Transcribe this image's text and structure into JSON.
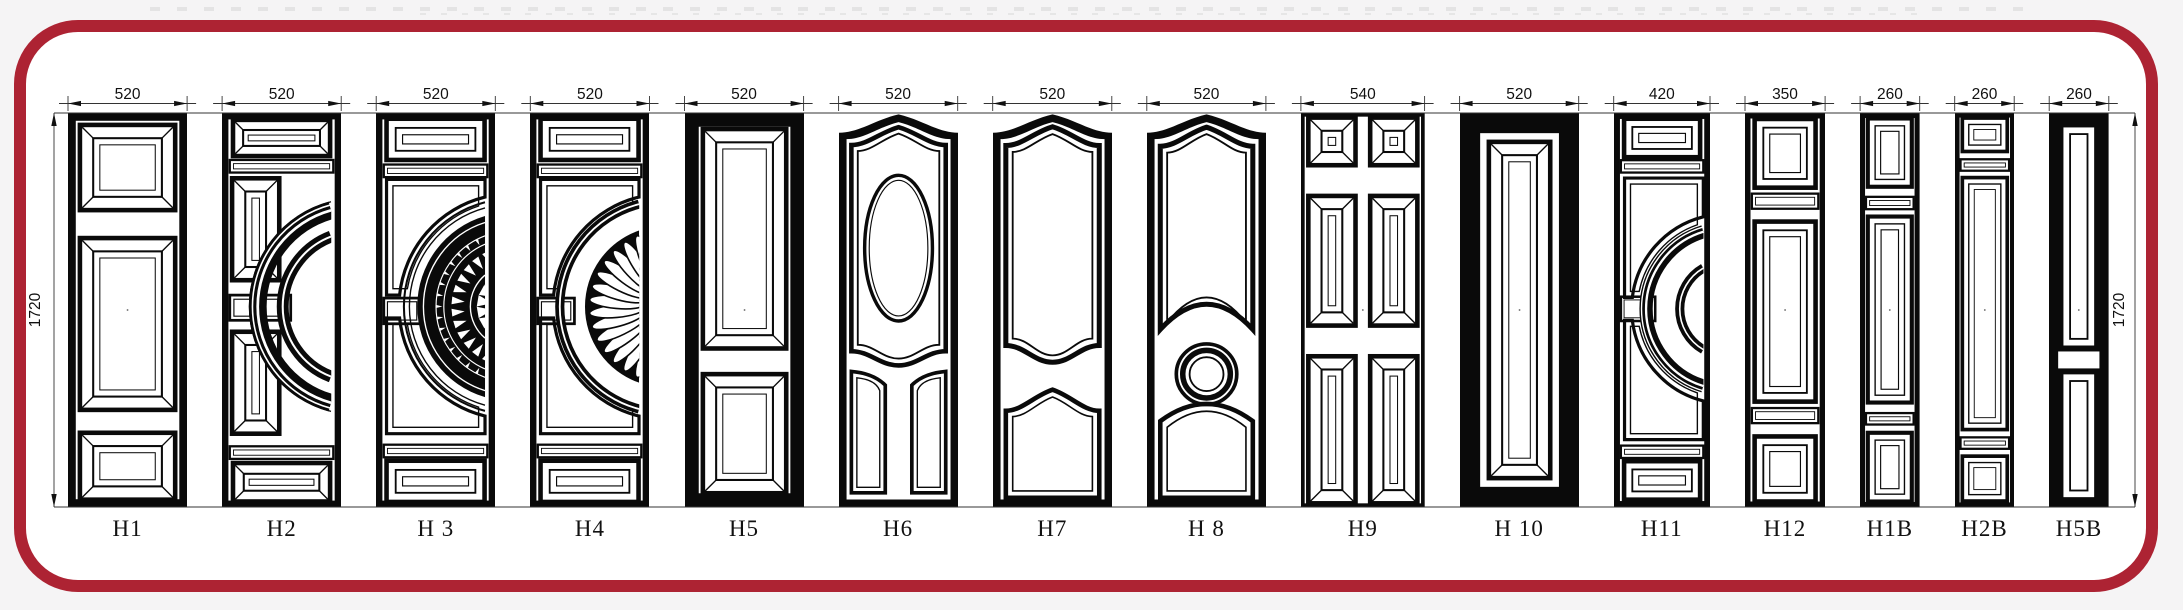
{
  "title": "Door panel design catalog drawing",
  "canvas": {
    "width": 2183,
    "height": 610
  },
  "colors": {
    "border_red": "#ad2333",
    "line_black": "#0a0a0a",
    "paper": "#ffffff",
    "outside_background": "#f5f4f5",
    "dim_line": "#333333"
  },
  "side_dimensions": {
    "left": "1720",
    "right": "1720"
  },
  "doors": [
    {
      "label": "H1",
      "dim": "520",
      "width_mm": 520,
      "height_mm": 1720,
      "design": "three-bevel-panels"
    },
    {
      "label": "H2",
      "dim": "520",
      "width_mm": 520,
      "height_mm": 1720,
      "design": "arc-moulding"
    },
    {
      "label": "H 3",
      "dim": "520",
      "width_mm": 520,
      "height_mm": 1720,
      "design": "arc-rosette"
    },
    {
      "label": "H4",
      "dim": "520",
      "width_mm": 520,
      "height_mm": 1720,
      "design": "arc-fan"
    },
    {
      "label": "H5",
      "dim": "520",
      "width_mm": 520,
      "height_mm": 1720,
      "design": "two-bevel-panels"
    },
    {
      "label": "H6",
      "dim": "520",
      "width_mm": 520,
      "height_mm": 1720,
      "design": "crown-oval"
    },
    {
      "label": "H7",
      "dim": "520",
      "width_mm": 520,
      "height_mm": 1720,
      "design": "crown-arches"
    },
    {
      "label": "H 8",
      "dim": "520",
      "width_mm": 520,
      "height_mm": 1720,
      "design": "crown-circle"
    },
    {
      "label": "H9",
      "dim": "540",
      "width_mm": 540,
      "height_mm": 1720,
      "design": "six-panel"
    },
    {
      "label": "H 10",
      "dim": "520",
      "width_mm": 520,
      "height_mm": 1720,
      "design": "single-bevel-panel"
    },
    {
      "label": "H11",
      "dim": "420",
      "width_mm": 420,
      "height_mm": 1720,
      "design": "arc-moulding-small"
    },
    {
      "label": "H12",
      "dim": "350",
      "width_mm": 350,
      "height_mm": 1720,
      "design": "three-nested-panels"
    },
    {
      "label": "H1B",
      "dim": "260",
      "width_mm": 260,
      "height_mm": 1720,
      "design": "three-nested-narrow"
    },
    {
      "label": "H2B",
      "dim": "260",
      "width_mm": 260,
      "height_mm": 1720,
      "design": "three-nested-slim"
    },
    {
      "label": "H5B",
      "dim": "260",
      "width_mm": 260,
      "height_mm": 1720,
      "design": "two-panels-narrow"
    }
  ]
}
